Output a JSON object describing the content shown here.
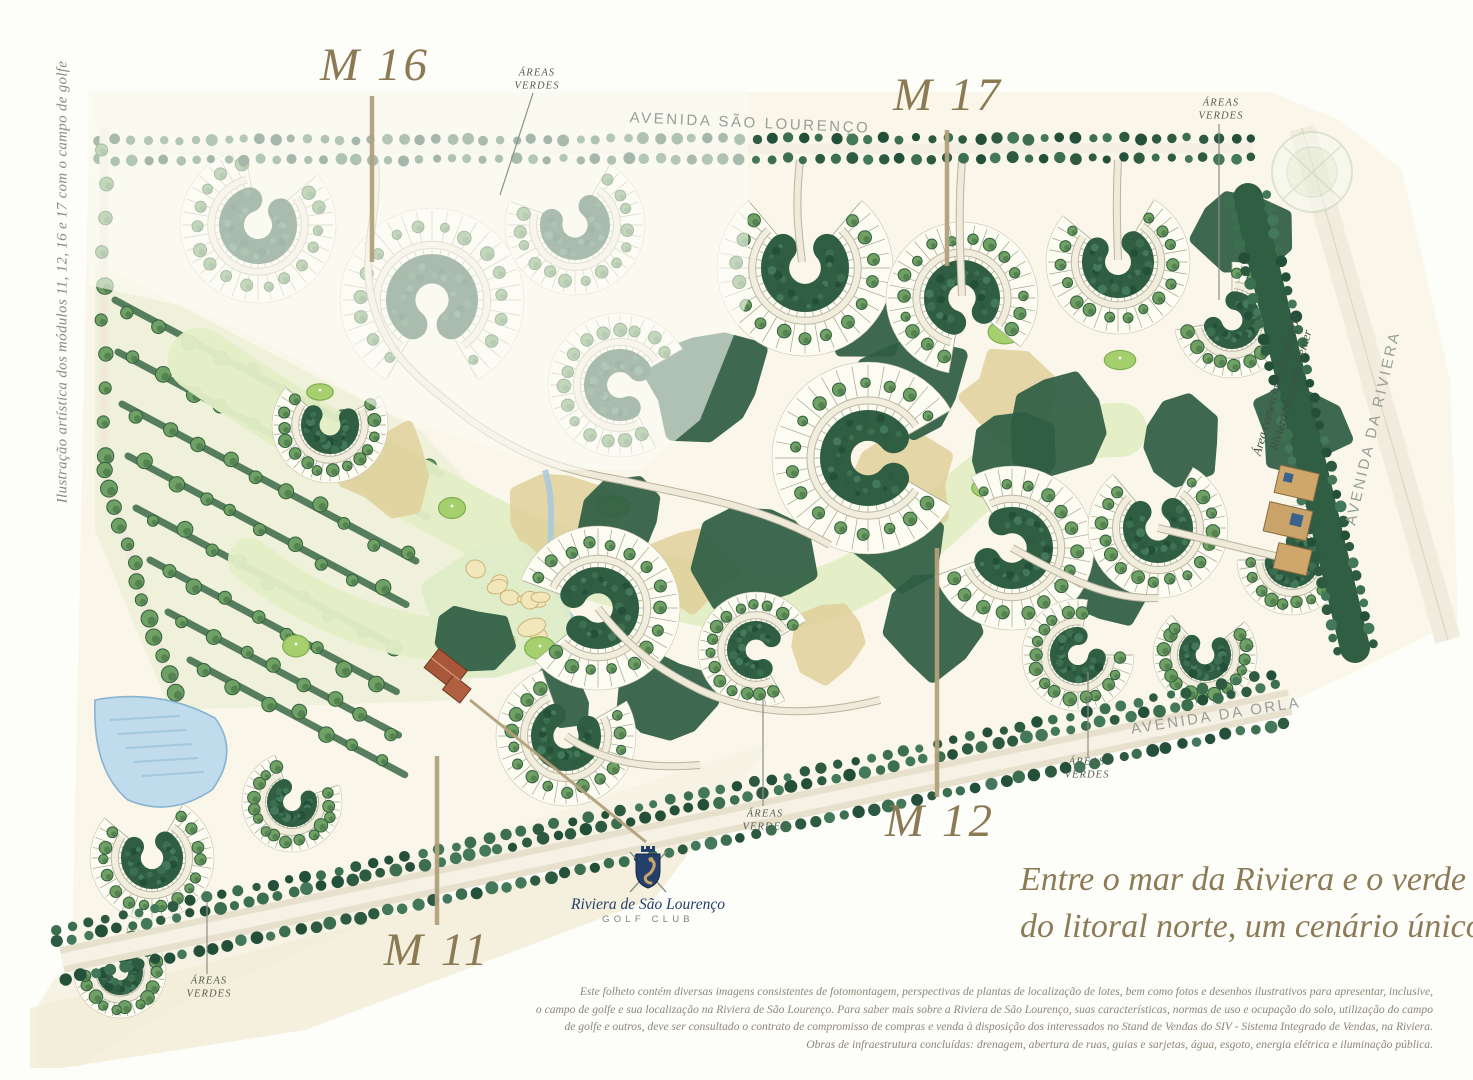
{
  "caption_left": "Ilustração artística dos módulos 11, 12, 16 e 17 com o campo de golfe",
  "modules": {
    "m16": "M 16",
    "m17": "M 17",
    "m12": "M 12",
    "m11": "M 11"
  },
  "areas_verdes": {
    "line1": "ÁREAS",
    "line2": "VERDES"
  },
  "avenues": {
    "sao_lourenco": "AVENIDA SÃO LOURENÇO",
    "riviera": "AVENIDA DA RIVIERA",
    "orla": "AVENIDA DA ORLA"
  },
  "commercial": {
    "line1": "Área comercial e de serviços",
    "line2": "Riviera Shopping Center"
  },
  "golf_club": {
    "name": "Riviera de São Lourenço",
    "subtitle": "GOLF CLUB"
  },
  "tagline": {
    "line1": "Entre o mar da Riviera e o verde",
    "line2": "do litoral norte, um cenário único."
  },
  "legal": {
    "line1": "Este folheto contém diversas imagens consistentes de fotomontagem, perspectivas de plantas de localização de lotes, bem como fotos e desenhos ilustrativos para apresentar, inclusive,",
    "line2": "o campo de golfe e sua localização na Riviera de São Lourenço. Para saber mais sobre a Riviera de São Lourenço, suas características, normas de uso e ocupação do solo, utilização do campo",
    "line3": "de golfe e outros, deve ser consultado o contrato de compromisso de compras e venda à disposição dos interessados no Stand de Vendas do SIV - Sistema Integrado de Vendas, na Riviera.",
    "line4": "Obras de infraestrutura concluídas: drenagem, abertura de ruas, guias e sarjetas, água, esgoto, energia elétrica e iluminação pública."
  },
  "colors": {
    "label_tan": "#8c7a55",
    "leader_tan": "#b3a17c",
    "foliage_dark": "#2e5b41",
    "foliage_light": "#6fa164",
    "lot_cream": "#fdfcf2",
    "water_blue": "#bfdbec",
    "logo_navy": "#23406b",
    "text_gray": "#8d8779"
  }
}
